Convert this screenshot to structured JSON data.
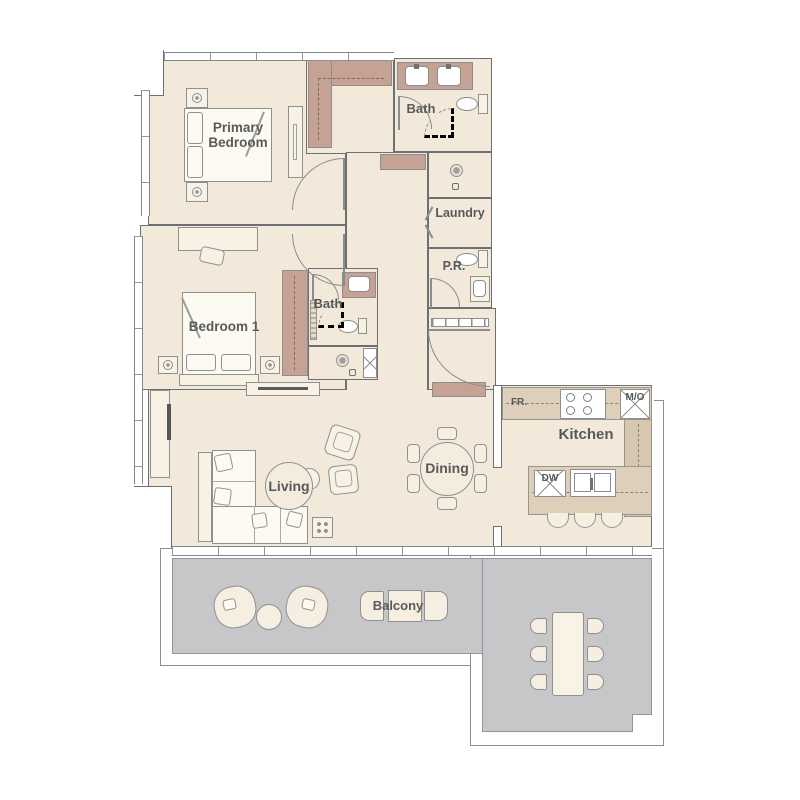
{
  "floor_plan": {
    "rooms": {
      "primary_bedroom": {
        "label": "Primary Bedroom"
      },
      "bath_main": {
        "label": "Bath"
      },
      "laundry": {
        "label": "Laundry"
      },
      "powder_room": {
        "label": "P.R."
      },
      "bedroom_1": {
        "label": "Bedroom 1"
      },
      "bath_2": {
        "label": "Bath"
      },
      "living": {
        "label": "Living"
      },
      "dining": {
        "label": "Dining"
      },
      "kitchen": {
        "label": "Kitchen"
      },
      "balcony": {
        "label": "Balcony"
      }
    },
    "appliances": {
      "fridge": {
        "label": "FR."
      },
      "microwave_oven": {
        "label": "M/O"
      },
      "dishwasher": {
        "label": "DW"
      }
    },
    "colors": {
      "floor": "#f2e9da",
      "closet": "#c6a294",
      "counter": "#ddcfba",
      "balcony_deck": "#c7c7c9",
      "wall_line": "#6e6f72",
      "label_text": "#58595b"
    }
  }
}
